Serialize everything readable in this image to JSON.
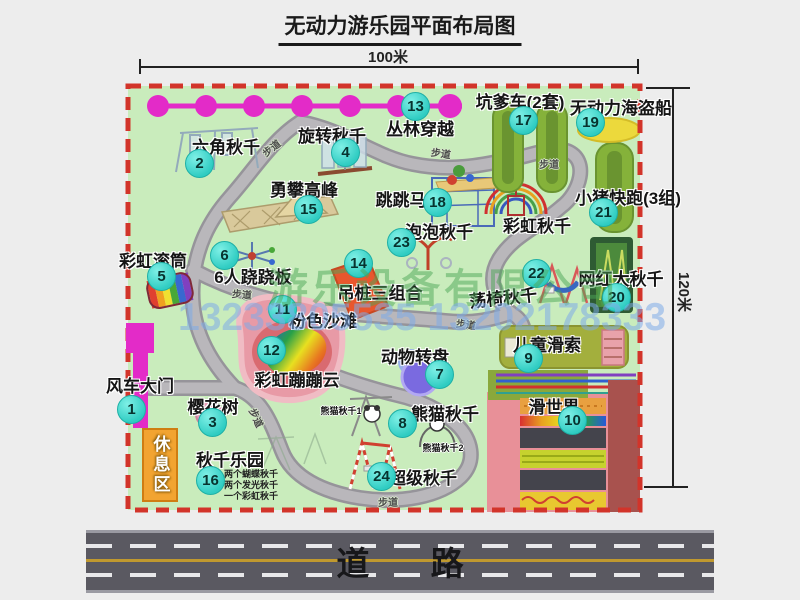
{
  "title": "无动力游乐园平面布局图",
  "dimensions": {
    "width_label": "100米",
    "height_label": "120米"
  },
  "road": {
    "label": "道 路"
  },
  "watermark": {
    "company": "游乐设备有限公司",
    "phone": "13233805535 13202178333"
  },
  "path_label": "步道",
  "rest_area_label": "休息区",
  "rainbow_swing_label": "彩虹秋千",
  "panda_sub1": "熊猫秋千1",
  "panda_sub2": "熊猫秋千2",
  "swing_park_notes": [
    "两个蝴蝶秋千",
    "两个发光秋千",
    "一个彩虹秋千"
  ],
  "attractions": [
    {
      "num": "1",
      "label": "风车大门"
    },
    {
      "num": "2",
      "label": "六角秋千"
    },
    {
      "num": "3",
      "label": "樱花树"
    },
    {
      "num": "4",
      "label": "旋转秋千"
    },
    {
      "num": "5",
      "label": "彩虹滚筒"
    },
    {
      "num": "6",
      "label": "6人跷跷板"
    },
    {
      "num": "7",
      "label": "动物转盘"
    },
    {
      "num": "8",
      "label": "熊猫秋千"
    },
    {
      "num": "9",
      "label": "儿童滑索"
    },
    {
      "num": "10",
      "label": "滑世界"
    },
    {
      "num": "11",
      "label": "粉色沙滩"
    },
    {
      "num": "12",
      "label": "彩虹蹦蹦云"
    },
    {
      "num": "13",
      "label": "丛林穿越"
    },
    {
      "num": "14",
      "label": "吊桩三组合"
    },
    {
      "num": "15",
      "label": "勇攀高峰"
    },
    {
      "num": "16",
      "label": "秋千乐园"
    },
    {
      "num": "17",
      "label": "坑爹车(2套)"
    },
    {
      "num": "18",
      "label": "跳跳马"
    },
    {
      "num": "19",
      "label": "无动力海盗船"
    },
    {
      "num": "20",
      "label": "网红大秋千"
    },
    {
      "num": "21",
      "label": "小猪快跑(3组)"
    },
    {
      "num": "22",
      "label": "荡椅秋千"
    },
    {
      "num": "23",
      "label": "泡泡秋千"
    },
    {
      "num": "24",
      "label": "超级秋千"
    }
  ],
  "colors": {
    "map_green": "#c9ecbc",
    "border_red": "#d2342a",
    "badge_teal": "#38d7cd",
    "gate_magenta": "#e32bc8",
    "road_gray": "#5a5961",
    "rest_orange": "#f2a431"
  }
}
